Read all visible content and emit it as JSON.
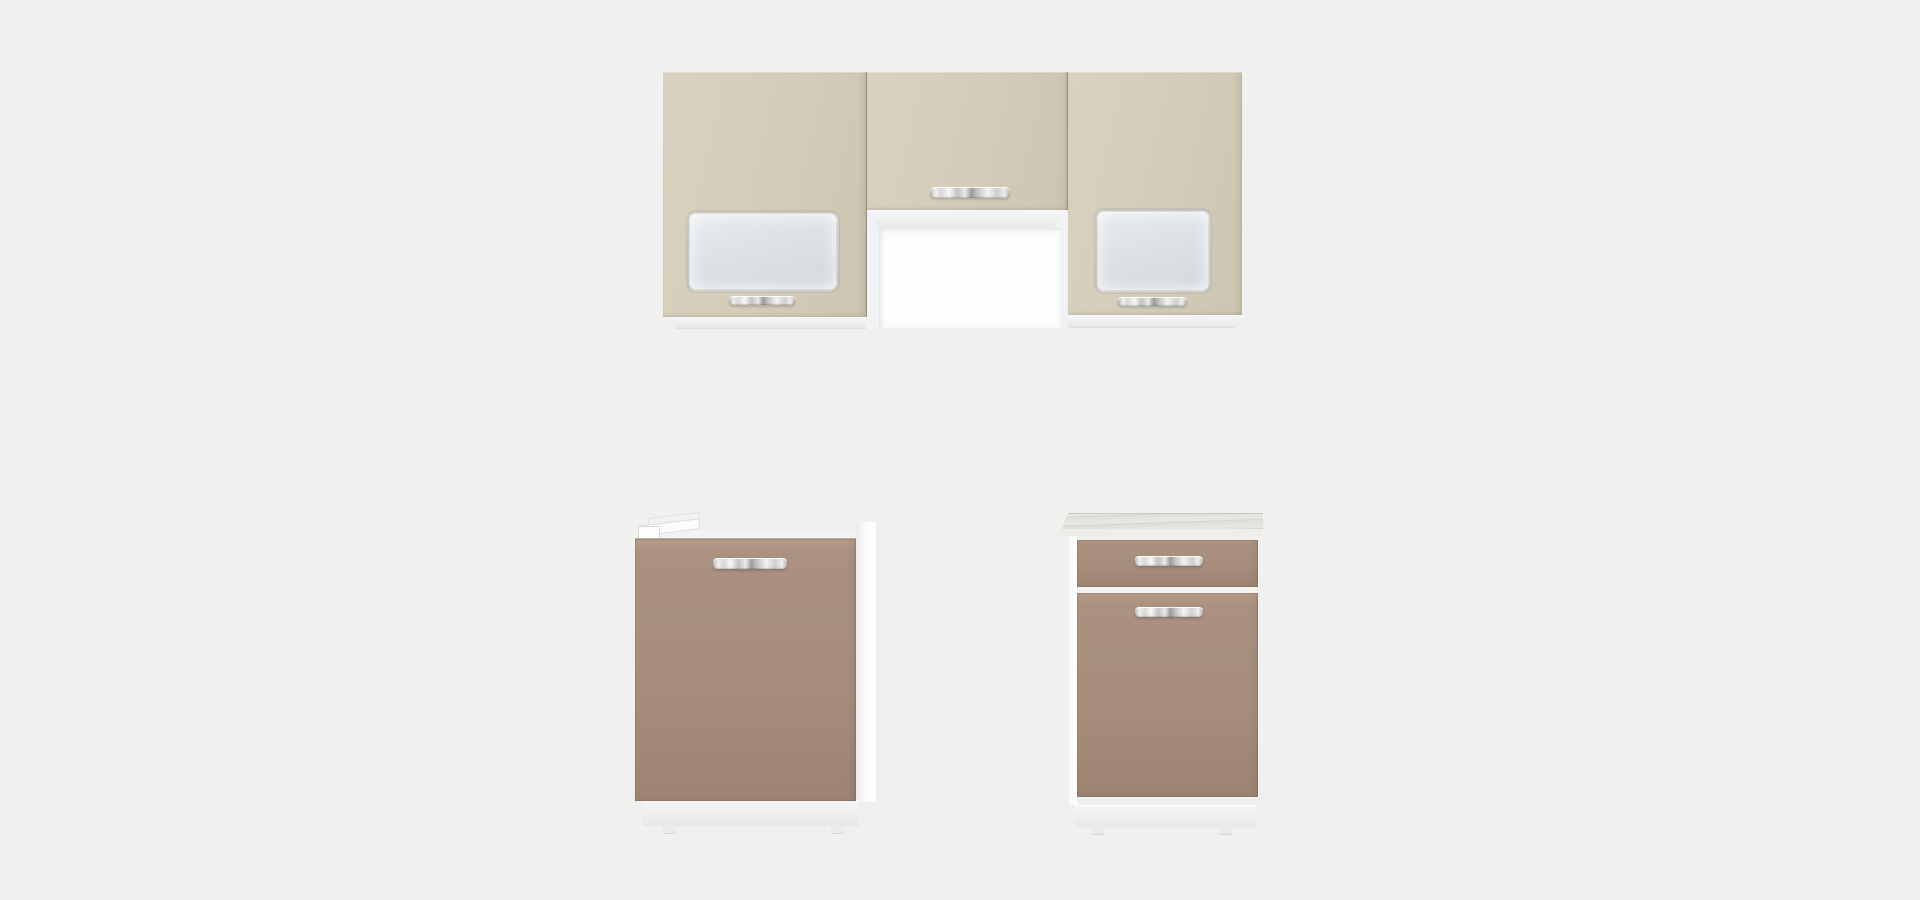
{
  "scene": {
    "subject": "Modular kitchen furniture set - front product render on plain studio background",
    "text_content": "none",
    "wall_row": {
      "left_cabinet": {
        "label": "Wall cabinet with frosted glass insert and chrome bar handle"
      },
      "middle_cabinet": {
        "label": "Short wall cabinet mounted over white recess, chrome bar handle on bottom edge"
      },
      "right_cabinet": {
        "label": "Wall cabinet with frosted glass insert and chrome bar handle"
      },
      "recess": {
        "label": "White open recess between tall wall cabinets"
      }
    },
    "base_row": {
      "sink_cabinet": {
        "label": "Base sink cabinet, single taupe door, chrome bar handle, white mounting bracket on top, white plinth"
      },
      "drawer_cabinet": {
        "label": "Base cabinet with top drawer and door, light worktop, chrome bar handles, white plinth"
      }
    },
    "handle_count": 6,
    "finish": {
      "upper_fronts": "matte cream",
      "lower_fronts": "matte taupe",
      "carcass": "white",
      "worktop": "light oak laminate"
    }
  },
  "colors": {
    "bg": "#f0f0ee",
    "cream": "#d3ccb9",
    "cream_light": "#d8d2c0",
    "cream_dark": "#ccc5b1",
    "cream_divider": "#96907e",
    "taupe": "#a78e7c",
    "taupe_light": "#b69b89",
    "taupe_dark": "#9d8372",
    "glass": "#dfe3e7",
    "glass_light": "#e9ecef",
    "glass_dark": "#d3d8dd",
    "carcass": "#fafafa",
    "alcove": "#fdfdfe",
    "alcove_frame": "#f1f2f4",
    "plinth_light": "#f6f6f6",
    "plinth_dark": "#e7e8e8",
    "counter": "#e7e5e0",
    "counter_streak": "#d8d5cf",
    "counter_edge": "#eeede9"
  }
}
